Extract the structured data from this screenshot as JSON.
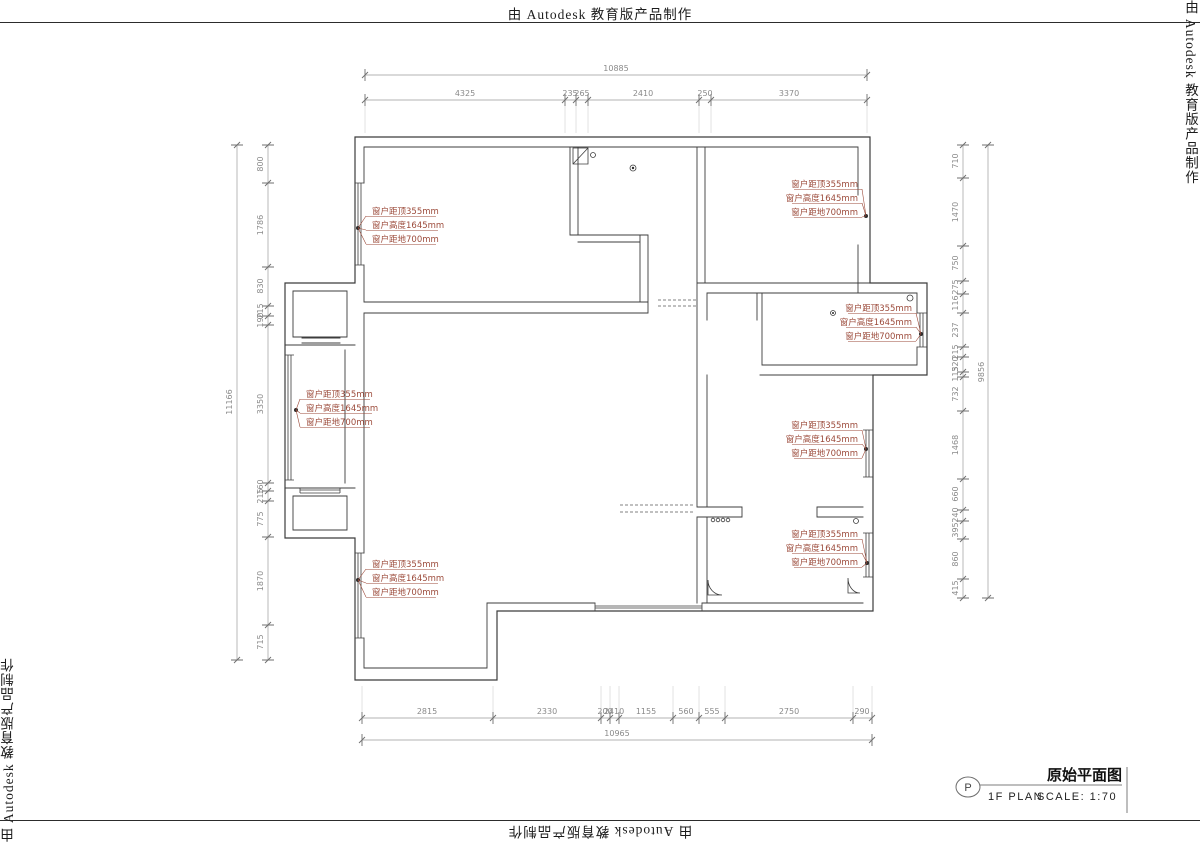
{
  "watermark": {
    "text": "由 Autodesk 教育版产品制作"
  },
  "title_block": {
    "marker": "P",
    "plan_label": "1F PLAN",
    "scale_label": "SCALE: 1:70",
    "title": "原始平面图"
  },
  "window_annotation": {
    "line1": "窗户距顶355mm",
    "line2": "窗户高度1645mm",
    "line3": "窗户距地700mm"
  },
  "dimensions": {
    "top": {
      "total": "10885",
      "segments": [
        "4325",
        "235",
        "265",
        "2410",
        "250",
        "3370"
      ]
    },
    "bottom": {
      "total": "10965",
      "segments": [
        "2815",
        "2330",
        "200",
        "2410",
        "1155",
        "560",
        "555",
        "2750",
        "290"
      ]
    },
    "left": {
      "total": "11166",
      "segments": [
        "800",
        "1786",
        "830",
        "215",
        "190",
        "3350",
        "160",
        "215",
        "775",
        "1870",
        "715"
      ]
    },
    "right": {
      "total": "9856",
      "segments": [
        "710",
        "1470",
        "750",
        "275",
        "116",
        "237",
        "215",
        "320",
        "115",
        "732",
        "1468",
        "660",
        "240",
        "395",
        "860",
        "415"
      ]
    }
  },
  "colors": {
    "wall_line": "#3c3c3c",
    "dimension_text": "#8a8a8a",
    "annotation_text": "#9c4b3b",
    "background": "#ffffff"
  }
}
